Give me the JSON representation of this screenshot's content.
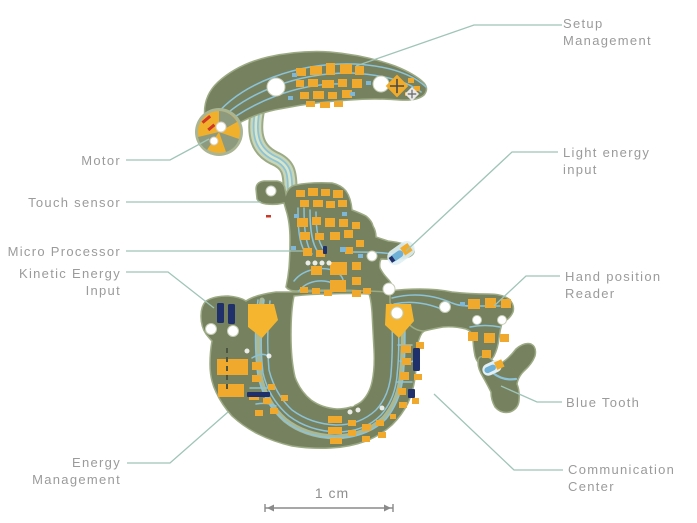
{
  "labels": {
    "setup": {
      "line1": "Setup",
      "line2": "Management"
    },
    "motor": {
      "line1": "Motor"
    },
    "touch": {
      "line1": "Touch sensor"
    },
    "micro": {
      "line1": "Micro Processor"
    },
    "kinetic": {
      "line1": "Kinetic Energy",
      "line2": "Input"
    },
    "light": {
      "line1": "Light energy",
      "line2": "input"
    },
    "hand": {
      "line1": "Hand position",
      "line2": "Reader"
    },
    "bluetooth": {
      "line1": "Blue Tooth"
    },
    "energy": {
      "line1": "Energy",
      "line2": "Management"
    },
    "comm": {
      "line1": "Communication",
      "line2": "Center"
    }
  },
  "scale_bar": {
    "label": "1 cm"
  },
  "colors": {
    "board_substrate": "#76815f",
    "board_rim": "#9dab85",
    "flex_band": "#c8d5b6",
    "trace_blue": "#8cc3d8",
    "pad_yellow": "#f1a92d",
    "component_navy": "#20306b",
    "motor_yellow": "#f0b02c",
    "leader_line": "#9fc4b8",
    "label_text": "#9b9b9b",
    "scale_bar_gray": "#8a8a8a"
  }
}
